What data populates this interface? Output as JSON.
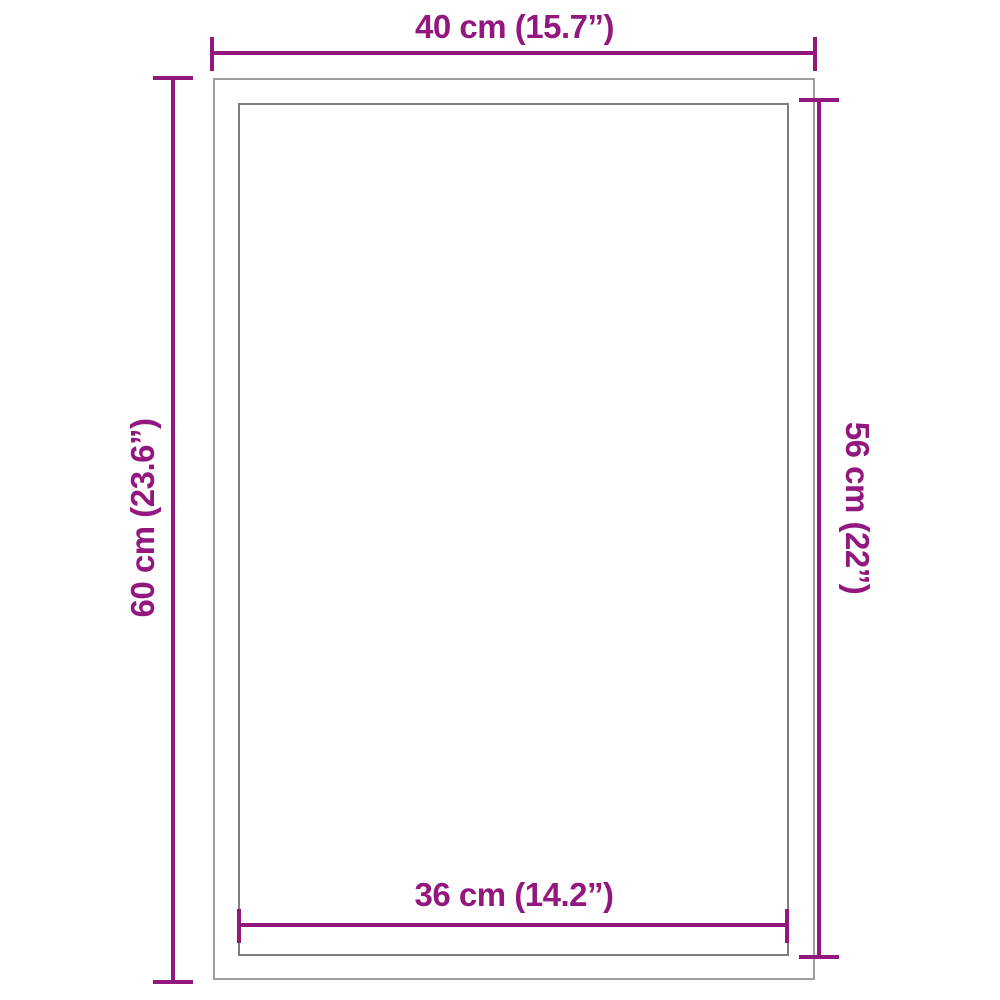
{
  "diagram": {
    "colors": {
      "accent": "#92177E",
      "outer_border": "#9d9d9d",
      "inner_border": "#7e7e7e",
      "background": "#ffffff"
    },
    "dimensions": {
      "top": {
        "label": "40 cm (15.7”)"
      },
      "left": {
        "label": "60 cm (23.6”)"
      },
      "right": {
        "label": "56 cm (22”)"
      },
      "bottom": {
        "label": "36 cm (14.2”)"
      }
    }
  }
}
